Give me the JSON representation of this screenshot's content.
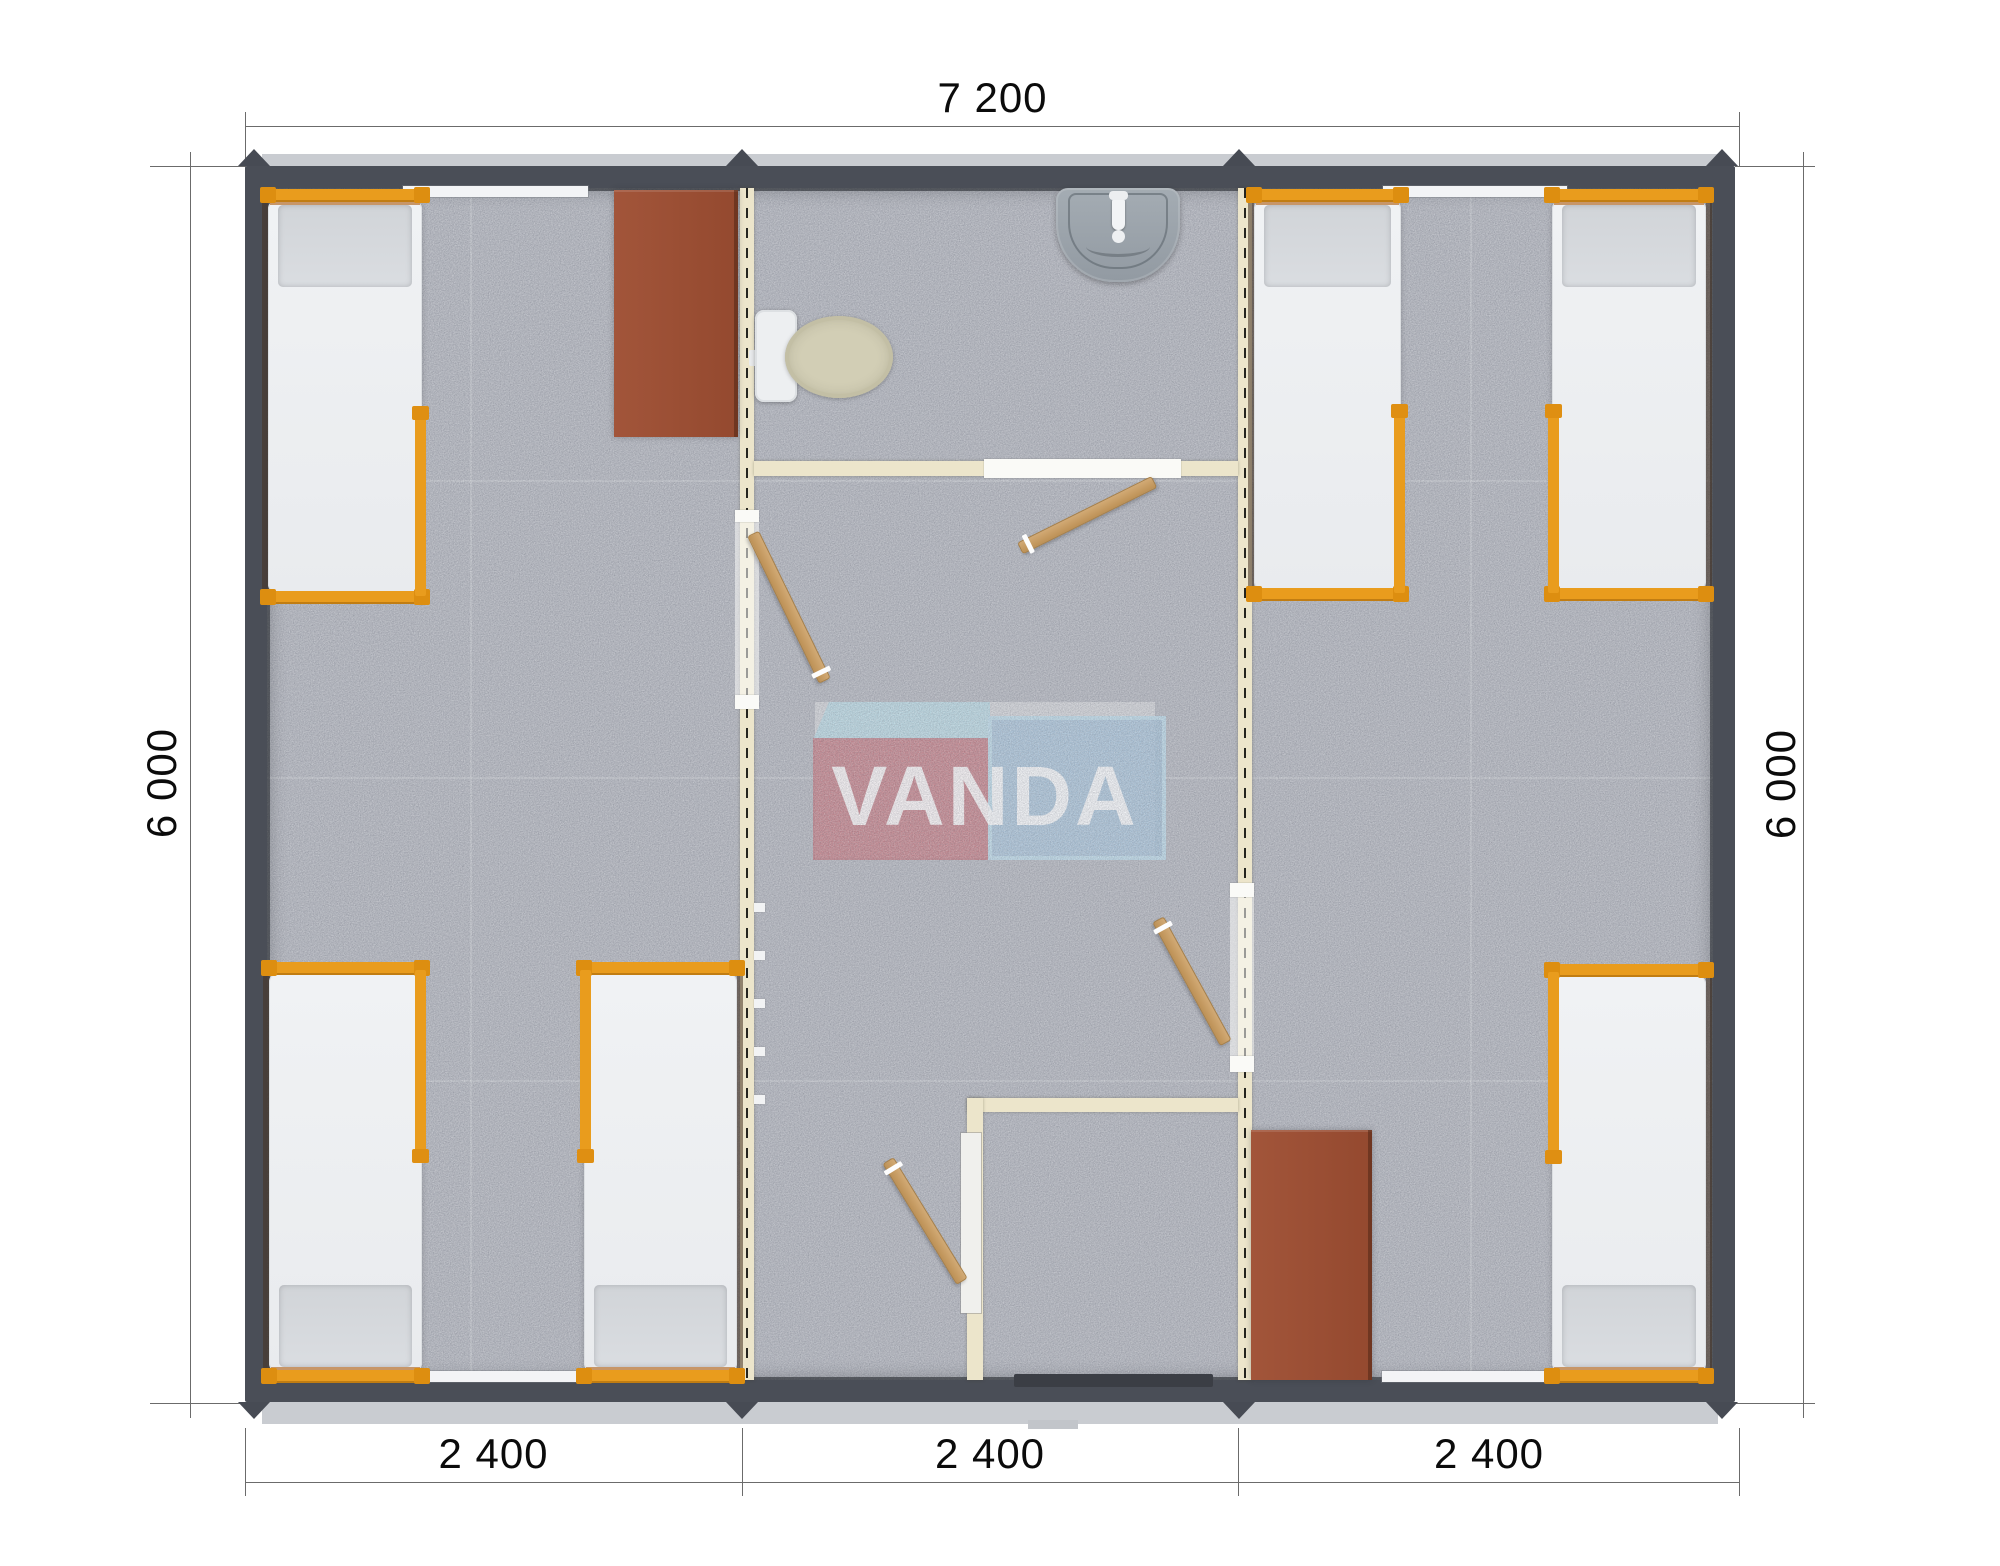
{
  "plan": {
    "type": "modular-building-floor-plan",
    "watermark": {
      "text": "VANDA",
      "red": "#c6737b",
      "blue": "#a9c7de",
      "light_blue": "#b7dde9"
    },
    "dimensions": {
      "top_width": "7 200",
      "left_height": "6 000",
      "right_height": "6 000",
      "bottom_segments": [
        "2 400",
        "2 400",
        "2 400"
      ]
    },
    "palette": {
      "exterior_wall": "#4a4e57",
      "floor": "#b7bac2",
      "interior_wall": "#ece5cb",
      "bed_frame_orange": "#e99c1d",
      "mattress": "#eef0f2",
      "cabinet_brown": "#9c5036",
      "door_wood": "#c9a06b",
      "sink_gray": "#9aa2aa",
      "toilet_bowl": "#d2ceb5",
      "eave_gray": "#c9ccd1"
    },
    "contents": {
      "modules": 3,
      "beds": 6,
      "cabinets": 2,
      "wood_doors": 4,
      "bathroom_fixtures": [
        "toilet",
        "sink"
      ],
      "shower_rooms": 1,
      "windows": 4
    }
  }
}
